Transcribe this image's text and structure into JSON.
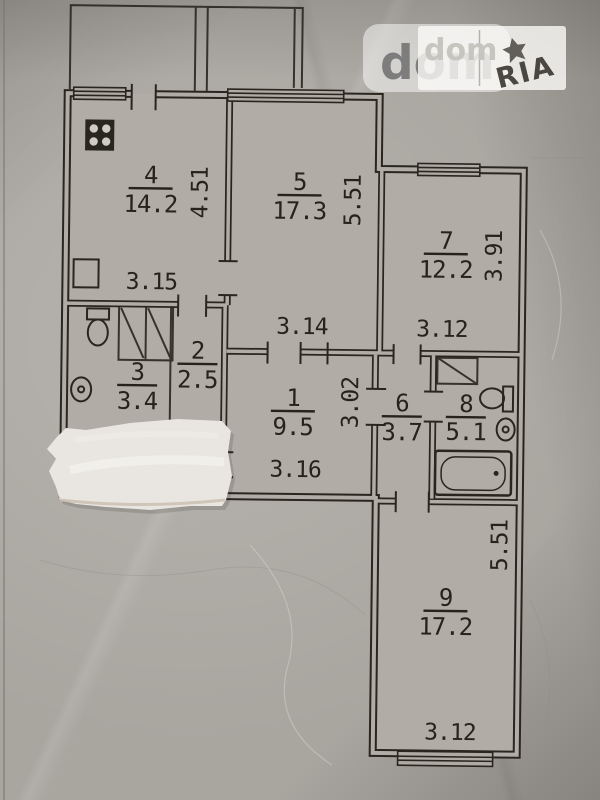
{
  "watermark": {
    "brand": "dom",
    "brand_overlay": "dom",
    "stamp": "RIA"
  },
  "rooms": [
    {
      "number": "4",
      "area": "14.2"
    },
    {
      "number": "5",
      "area": "17.3"
    },
    {
      "number": "7",
      "area": "12.2"
    },
    {
      "number": "2",
      "area": "2.5"
    },
    {
      "number": "3",
      "area": "3.4"
    },
    {
      "number": "1",
      "area": "9.5"
    },
    {
      "number": "6",
      "area": "3.7"
    },
    {
      "number": "8",
      "area": "5.1"
    },
    {
      "number": "9",
      "area": "17.2"
    }
  ],
  "dimensions": {
    "horizontal": [
      {
        "value": "3.15"
      },
      {
        "value": "3.14"
      },
      {
        "value": "3.12"
      },
      {
        "value": "3.16"
      },
      {
        "value": "3.12"
      }
    ],
    "vertical": [
      {
        "value": "4.51"
      },
      {
        "value": "5.51"
      },
      {
        "value": "3.91"
      },
      {
        "value": "3.02"
      },
      {
        "value": "5.51"
      }
    ]
  },
  "colors": {
    "paper": "#a9a59f",
    "line": "#29261f",
    "ink": "#26231d",
    "wall_gap": "#b1ada6",
    "strip": "#e9e6e1",
    "watermark_text": "#6f6f6f"
  }
}
